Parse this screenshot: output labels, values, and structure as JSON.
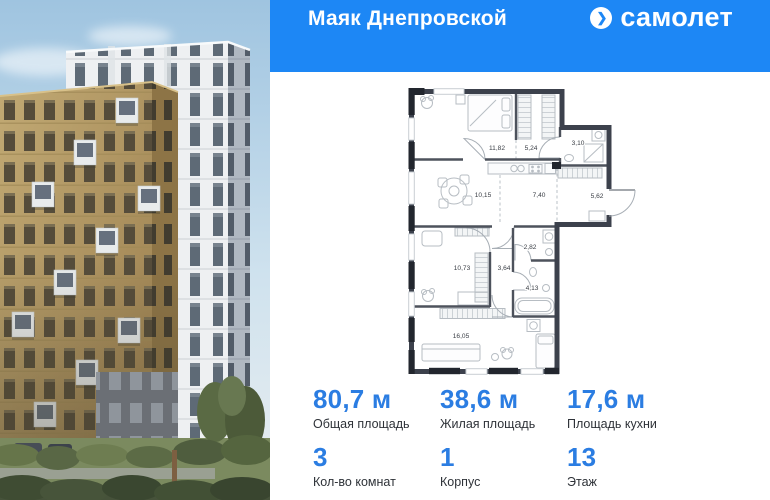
{
  "colors": {
    "header_bg": "#1d87f5",
    "accent_blue": "#2b7de2",
    "text_dark": "#2e3238",
    "plan_wall": "#3c414c"
  },
  "header": {
    "project_title": "Маяк Днепровской",
    "brand_name": "самолет",
    "brand_icon": "samolet-arrow-in-circle"
  },
  "plan": {
    "rooms": [
      {
        "name": "bedroom-1",
        "area": "11,82"
      },
      {
        "name": "wardrobe",
        "area": "5,24"
      },
      {
        "name": "bathroom-1",
        "area": "3,10"
      },
      {
        "name": "living-dining",
        "area": "10,15"
      },
      {
        "name": "kitchen-zone",
        "area": "7,40"
      },
      {
        "name": "hallway",
        "area": "5,62"
      },
      {
        "name": "laundry",
        "area": "2,82"
      },
      {
        "name": "bedroom-2",
        "area": "10,73"
      },
      {
        "name": "corridor",
        "area": "3,64"
      },
      {
        "name": "bathroom-2",
        "area": "4,13"
      },
      {
        "name": "bedroom-3",
        "area": "16,05"
      }
    ]
  },
  "stats": {
    "areas": [
      {
        "value": "80,7 м",
        "label": "Общая площадь"
      },
      {
        "value": "38,6 м",
        "label": "Жилая площадь"
      },
      {
        "value": "17,6 м",
        "label": "Площадь кухни"
      }
    ],
    "details": [
      {
        "value": "3",
        "label": "Кол-во комнат"
      },
      {
        "value": "1",
        "label": "Корпус"
      },
      {
        "value": "13",
        "label": "Этаж"
      }
    ]
  }
}
